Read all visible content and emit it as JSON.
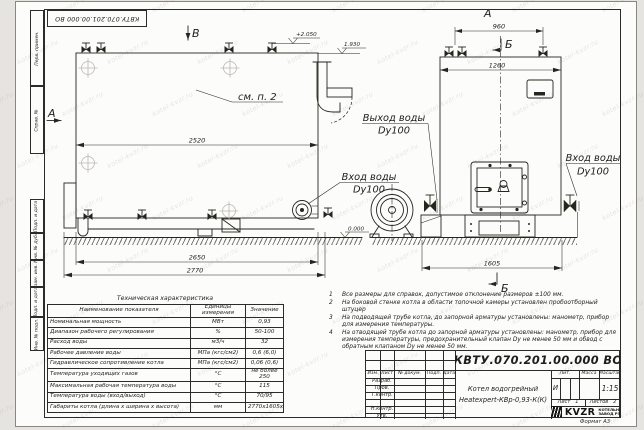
{
  "watermark": {
    "text": "kotel-kvzr.ru"
  },
  "corner_stamp": {
    "doc_number": "КВТУ.070.201.00.000  ВО"
  },
  "frame_columns": {
    "c1": "Перв. примен.",
    "c2": "Справ. №",
    "c3": "Подп. и дата",
    "c4": "Инв. № дубл.",
    "c5": "Взам. инв. №",
    "c6": "Подп. и дата",
    "c7": "Инв. № подл."
  },
  "drawing": {
    "view_labels": {
      "top_b": "В",
      "left_a": "А",
      "front_a": "А",
      "section_b_top": "Б",
      "section_b_bottom": "Б"
    },
    "see_note": "см. п. 2",
    "dims": {
      "length_top": "2520",
      "length_mid": "2650",
      "length_total": "2770",
      "front_top": "960",
      "front_width": "1260",
      "front_total": "1605"
    },
    "elevations": {
      "top": "+2.050",
      "mid": "1.930",
      "ground": "0.000"
    },
    "callouts": {
      "outlet_title": "Выход воды",
      "outlet_dn": "Dy100",
      "inlet_side_title": "Вход воды",
      "inlet_side_dn": "Dy100",
      "inlet_front_title": "Вход воды",
      "inlet_front_dn": "Dy100"
    }
  },
  "tech_table": {
    "title": "Техническая характеристика",
    "headers": [
      "Наименование показателя",
      "Единицы измерения",
      "Значение"
    ],
    "rows": [
      [
        "Номинальная мощность",
        "МВт",
        "0,93"
      ],
      [
        "Диапазон рабочего регулирования",
        "%",
        "50-100"
      ],
      [
        "Расход воды",
        "м3/ч",
        "32"
      ],
      [
        "Рабочее давление воды",
        "МПа (кгс/см2)",
        "0,6 (6,0)"
      ],
      [
        "Гидравлическое сопротивление котла",
        "МПа (кгс/см2)",
        "0,06 (0,6)"
      ],
      [
        "Температура уходящих газов",
        "°С",
        "не более 250"
      ],
      [
        "Максимальная рабочая температура воды",
        "°С",
        "115"
      ],
      [
        "Температура воды (вход/выход)",
        "°С",
        "70/95"
      ],
      [
        "Габариты котла (длина х ширина х высота)",
        "мм",
        "2770х1605х2050"
      ]
    ]
  },
  "notes": {
    "items": [
      {
        "n": "1",
        "t": "Все размеры для справок, допустимое отклонение размеров ±100 мм."
      },
      {
        "n": "2",
        "t": "На боковой стенке котла в области топочной камеры установлен пробоотборный штуцер"
      },
      {
        "n": "3",
        "t": "На  подводящей трубе котла, до запорной арматуры установлены: манометр, прибор для измерения температуры."
      },
      {
        "n": "4",
        "t": "На отводящей трубе котла до запорной арматуры установлены: манометр, прибор для измерения температуры, предохранительный клапан Dу не менее 50 мм и обвод с обратным клапаном Dу не менее 50 мм."
      }
    ]
  },
  "title_block": {
    "doc_number": "КВТУ.070.201.00.000  ВО",
    "product_line1": "Котел водогрейный",
    "product_line2": "Heatexpert-КВр-0,93-К(К)",
    "col_izm": "Изм.",
    "col_list": "Лист",
    "col_doc": "№ докум.",
    "col_sign": "Подп.",
    "col_date": "Дата",
    "row_razrab": "Разраб.",
    "row_prov": "Пров.",
    "row_tkontr": "Т.контр.",
    "row_nkontr": "Н.контр.",
    "row_utv": "Утв.",
    "lit_label": "Лит.",
    "lit_value": "И",
    "mass_label": "Масса",
    "scale_label": "Масштаб",
    "scale_value": "1:15",
    "sheet_label": "Лист",
    "sheet_num": "1",
    "sheets_label": "Листов",
    "sheets_num": "2",
    "logo_text": "KVZR",
    "logo_line1": "КОТЕЛЬНЫЙ",
    "logo_line2": "ЗАВОД РЭП",
    "format_label": "Формат  А3"
  }
}
